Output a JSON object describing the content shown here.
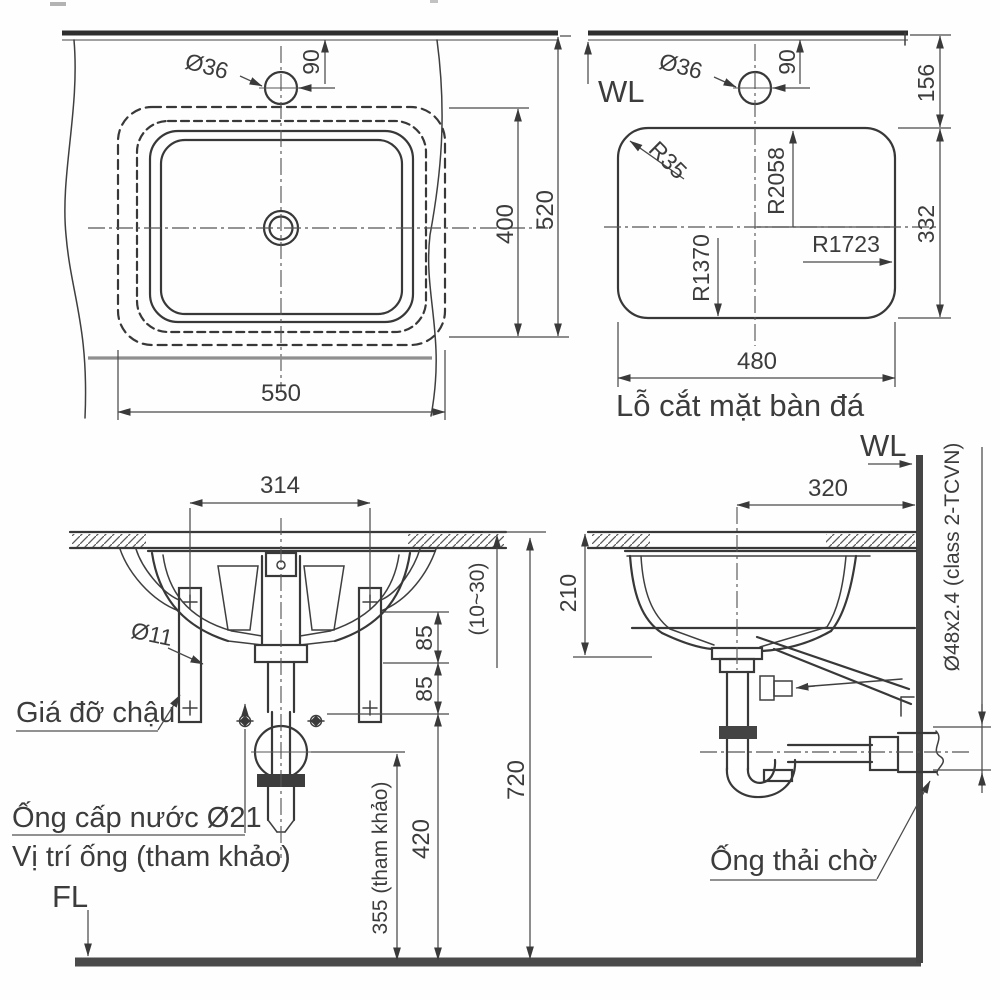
{
  "drawing": {
    "kind": "sink-installation-technical-drawing"
  },
  "plan": {
    "dim_hole": "Ø36",
    "dim_offset": "90",
    "dim_inner_depth": "400",
    "dim_total_depth": "520",
    "dim_width": "550"
  },
  "cutout": {
    "wl": "WL",
    "dim_hole": "Ø36",
    "dim_offset": "90",
    "dim_top": "156",
    "dim_height": "332",
    "dim_width": "480",
    "r_corner": "R35",
    "r_back": "R2058",
    "r_side": "R1723",
    "r_front": "R1370",
    "caption": "Lỗ cắt mặt bàn đá"
  },
  "front": {
    "dim_span": "314",
    "dim_bracket_hole": "Ø11",
    "label_bracket": "Giá đỡ chậu",
    "label_supply": "Ống cấp nước Ø21",
    "label_pipe_pos": "Vị trí ống (tham khảo)",
    "floor_level": "FL",
    "dim_gap_upper": "85",
    "dim_gap_lower": "85",
    "dim_counter_thickness": "(10~30)",
    "dim_supply_height": "420",
    "dim_ref_height": "355 (tham khảo)",
    "dim_total_height": "720"
  },
  "side": {
    "water_level": "WL",
    "dim_depth": "320",
    "dim_bowl_depth": "210",
    "pipe_spec": "Ø48x2.4 (class 2-TCVN)",
    "label_waste": "Ống thải chờ"
  }
}
